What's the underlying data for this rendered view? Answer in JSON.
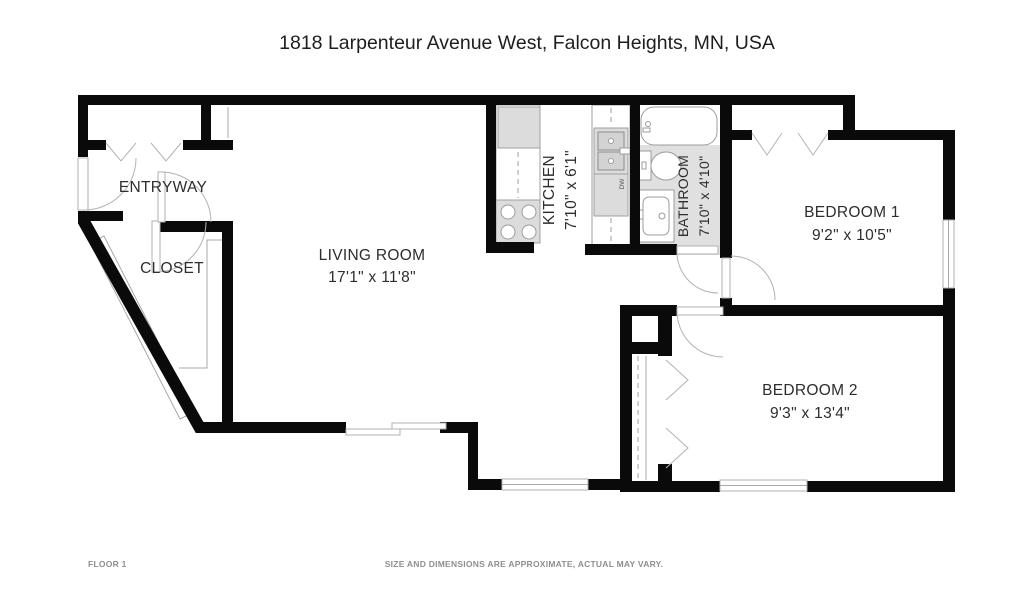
{
  "title": "1818 Larpenteur Avenue West, Falcon Heights, MN, USA",
  "rooms": {
    "entryway": {
      "name": "ENTRYWAY"
    },
    "closet": {
      "name": "CLOSET"
    },
    "living_room": {
      "name": "LIVING ROOM",
      "dimensions": "17'1\" x 11'8\""
    },
    "kitchen": {
      "name": "KITCHEN",
      "dimensions": "7'10\" x 6'1\""
    },
    "bathroom": {
      "name": "BATHROOM",
      "dimensions": "7'10\" x 4'10\""
    },
    "bedroom_1": {
      "name": "BEDROOM 1",
      "dimensions": "9'2\" x 10'5\""
    },
    "bedroom_2": {
      "name": "BEDROOM 2",
      "dimensions": "9'3\" x 13'4\""
    }
  },
  "labels": {
    "dishwasher": "DW"
  },
  "footer": {
    "floor": "FLOOR 1",
    "disclaimer": "SIZE AND DIMENSIONS ARE APPROXIMATE, ACTUAL MAY VARY."
  },
  "colors": {
    "wall": "#0a0a0a",
    "fixture_gray": "#dcdcdc",
    "bathroom_floor": "#e0e0e0",
    "label_text": "#2d2d2d",
    "footer_text": "#8f8f8f"
  }
}
